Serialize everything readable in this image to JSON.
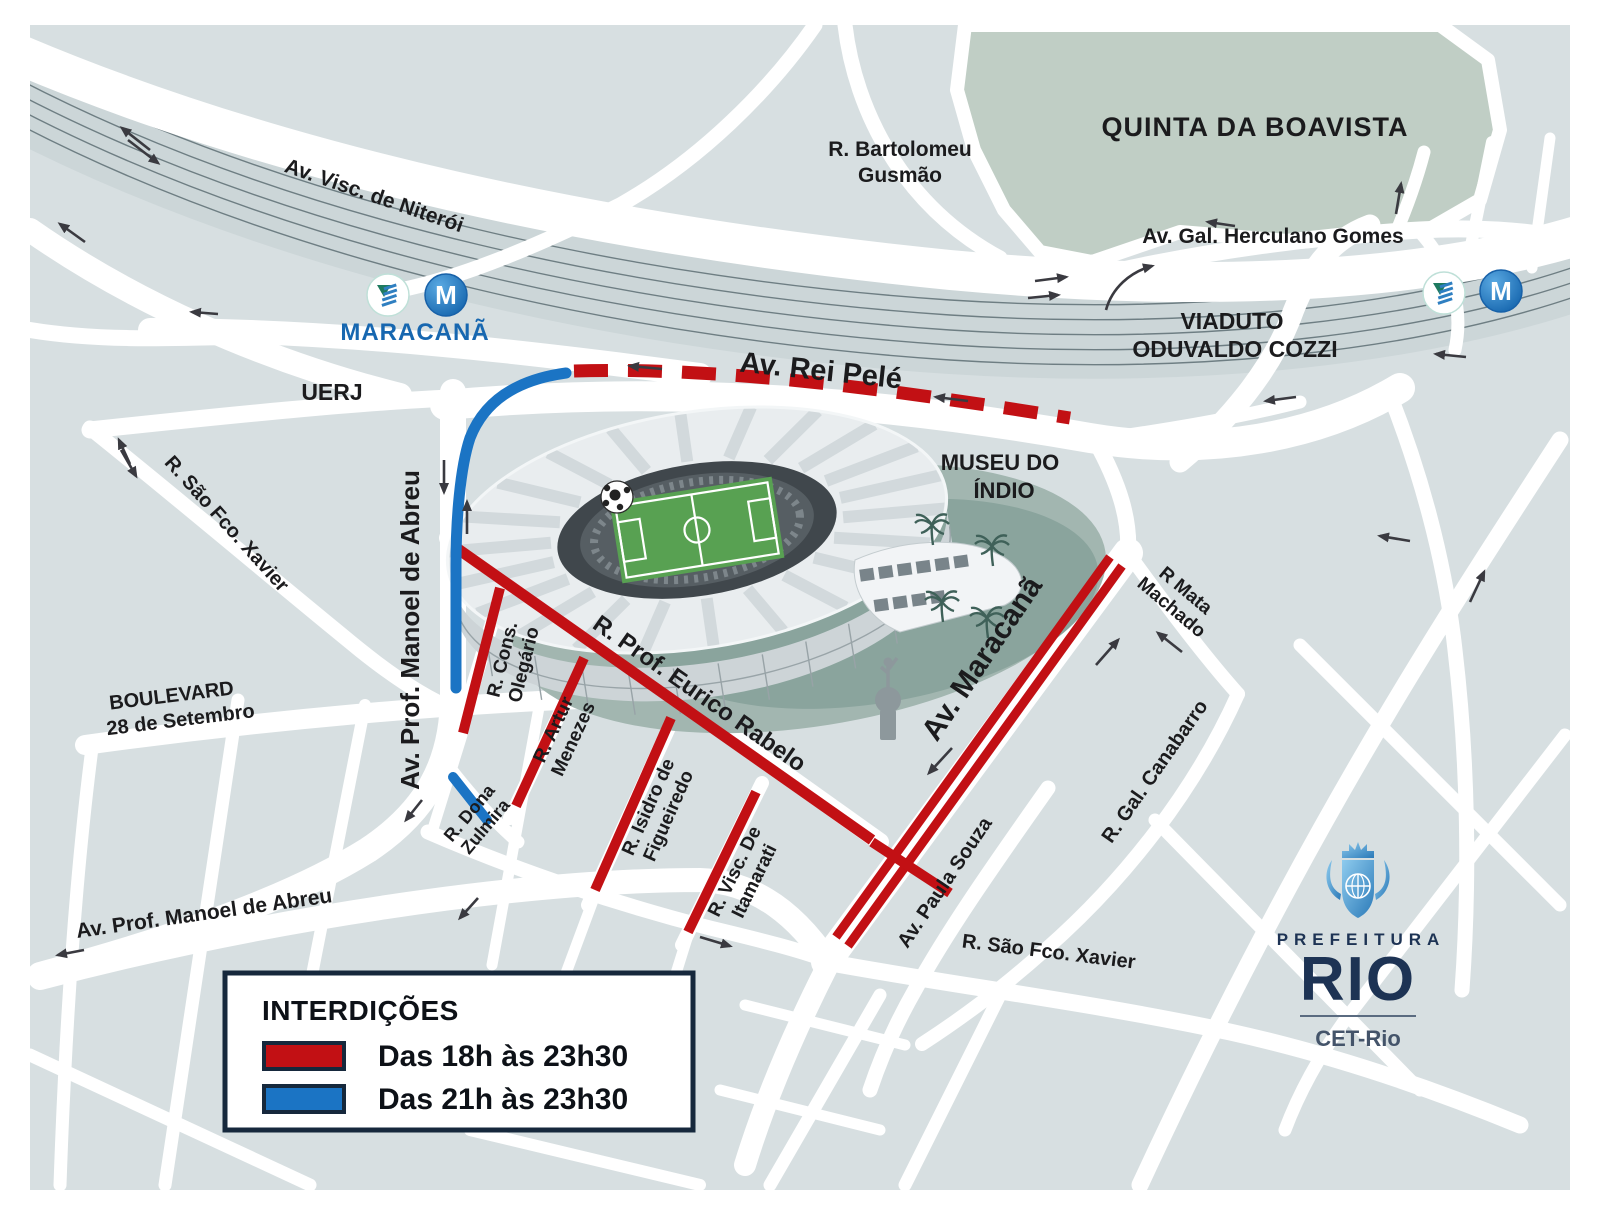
{
  "colors": {
    "map_bg": "#d7dfe1",
    "road": "#ffffff",
    "park": "#c0cec5",
    "rail_band": "#ccd6d8",
    "rail_line": "#6e7e83",
    "closure_18h": "#c21014",
    "closure_21h": "#1b74c4",
    "label": "#1b1b1d",
    "station_blue": "#1767b0",
    "legend_border": "#16283c",
    "logo_navy": "#1d3354"
  },
  "areas": {
    "park": "QUINTA DA BOAVISTA",
    "uerj": "UERJ",
    "museum_line1": "MUSEU DO",
    "museum_line2": "ÍNDIO",
    "viaduct_line1": "VIADUTO",
    "viaduct_line2": "ODUVALDO COZZI"
  },
  "streets": {
    "visc_niteroi": "Av. Visc. de Niterói",
    "bartolomeu_line1": "R. Bartolomeu",
    "bartolomeu_line2": "Gusmão",
    "herculano": "Av. Gal. Herculano Gomes",
    "rei_pele": "Av. Rei Pelé",
    "manoel_abreu_left": "Av. Prof. Manoel de Abreu",
    "manoel_abreu_bottom": "Av. Prof. Manoel de Abreu",
    "sao_fco_xavier_upper": "R. São Fco. Xavier",
    "sao_fco_xavier_lower": "R. São Fco. Xavier",
    "boulevard_line1": "BOULEVARD",
    "boulevard_line2": "28 de Setembro",
    "cons_olegario_line1": "R. Cons.",
    "cons_olegario_line2": "Olegário",
    "artur_menezes_line1": "R. Artur",
    "artur_menezes_line2": "Menezes",
    "isidro_line1": "R. Isidro de",
    "isidro_line2": "Figueiredo",
    "itamarati_line1": "R. Visc. De",
    "itamarati_line2": "Itamarati",
    "eurico_rabelo": "R. Prof. Eurico Rabelo",
    "av_maracana": "Av. Maracanã",
    "dona_zulmira_line1": "R. Dona",
    "dona_zulmira_line2": "Zulmira",
    "mata_machado_line1": "R Mata",
    "mata_machado_line2": "Machado",
    "gal_canabarro": "R. Gal. Canabarro",
    "paula_souza": "Av. Paula Souza"
  },
  "station": {
    "name": "MARACANÃ",
    "metro_letter": "M"
  },
  "legend": {
    "title": "INTERDIÇÕES",
    "items": [
      {
        "label": "Das 18h às 23h30",
        "color": "#c21014"
      },
      {
        "label": "Das 21h às 23h30",
        "color": "#1b74c4"
      }
    ]
  },
  "logo": {
    "line1": "PREFEITURA",
    "line2": "RIO",
    "agency": "CET-Rio"
  }
}
